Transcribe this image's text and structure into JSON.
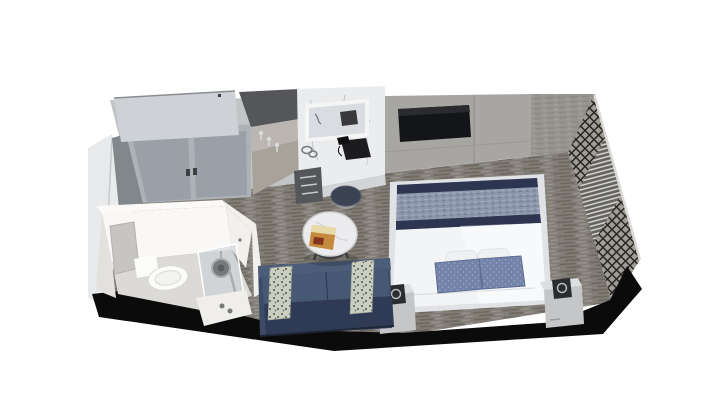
{
  "scene": {
    "type": "3d-stateroom-cutaway-render",
    "view": "isometric-top-down",
    "background": "#ffffff"
  },
  "objects": {
    "wardrobe": "sliding-door closet",
    "hook_niche": "angled wall with coat hooks",
    "vanity": "marble vanity desk with mirror, telephone, hair dryer, drawers, stool",
    "tv": "wall-mounted flat TV",
    "bed": "double bed with blue throw, white duvet, blue and white pillows",
    "nightstands": "two marble nightstands with black lamps",
    "sofa": "navy loveseat with two patterned pillows",
    "coffee_table": "round marble table with magazine",
    "bathroom": "bathroom pod with toilet, mirror cabinet and glass shower",
    "screen_wall": "dark lattice screen with slatted blinds on right wall",
    "carpet": "gray woven striped carpet",
    "cut_edges": "black cutaway floor/wall edges"
  },
  "colors": {
    "bg": "#ffffff",
    "cut": "#0b0b0c",
    "carpetBase": "#827d76",
    "carpetDark": "#6c675f",
    "carpetLight": "#96918a",
    "wallTop": "#c2c4c6",
    "closetTop": "#ced2d7",
    "closetDoor": "#adb2b7",
    "closetInset": "#9aa0a7",
    "closetSide": "#82878c",
    "closetHandle": "#3d3e41",
    "nicheShadow": "#55565a",
    "nicheWall": "#a8a29b",
    "hook": "#d9dadc",
    "marble": "#ebecee",
    "marbleVein": "#b6b9bf",
    "counterFront": "#d2d4d7",
    "drawer": "#55565a",
    "drawerHandle": "#c7c9cc",
    "mirrorFrame": "#f5f5f6",
    "mirrorGlass": "#d9dce0",
    "phone": "#1c1c1e",
    "tvWall": "#a8a6a2",
    "tvWallSeam": "#908e8a",
    "tv": "#141518",
    "farRight": "#98948f",
    "farRightDark": "#8b8783",
    "farRightLight": "#a5a19c",
    "leftWall": "#e8eaeb",
    "leftWallShade": "#c6c8ca",
    "latticeBase": "#a09c97",
    "lattice": "#282420",
    "latticeRim": "#d9d8d5",
    "blindsBg": "#63625f",
    "blindsLine": "#d7d6d3",
    "duvet": "#f3f4f6",
    "duvetShade": "#e0e2e5",
    "throw": "#8d97ac",
    "throwLite": "#a6aec0",
    "throwDeep": "#6e7890",
    "trim": "#2d3550",
    "pillowBlue": "#7483a9",
    "pillowBlueDot": "#9aa6c6",
    "pillowBlueDark": "#5c6b92",
    "pillowWhite": "#eef0f2",
    "nightTop": "#dddee0",
    "nightFront": "#c5c6c8",
    "lampBody": "#2b2c2f",
    "lampSilver": "#b9bbbe",
    "sofa": "#3c4b66",
    "sofaLite": "#4c5d7a",
    "sofaSeat": "#475874",
    "sofaDark": "#2f3b55",
    "sofaOutline": "#1f2737",
    "sofaPillow": "#c9cec0",
    "sofaPillowPat": "#4f5a49",
    "tableTop": "#ececee",
    "tableEdge": "#cfd0d3",
    "tableBase": "#3b3b3e",
    "magazine": "#c68a3e",
    "magazineDark": "#84341f",
    "magazineLight": "#e8d9a8",
    "stool": "#3b4252",
    "stoolLeg": "#9a9ca1",
    "bathWall": "#f1f0ed",
    "bathWallBright": "#f9f8f6",
    "bathWallSide": "#e3e1dd",
    "bathCap": "#fbfaf8",
    "bathFloor": "#dcdad6",
    "bathCab": "#c6c5c2",
    "toilet": "#fbfbfa",
    "toiletShade": "#d8d7d3",
    "glass": "rgba(197,206,213,0.5)",
    "fixture": "#aaacaf",
    "fixtureDark": "#77797c"
  }
}
